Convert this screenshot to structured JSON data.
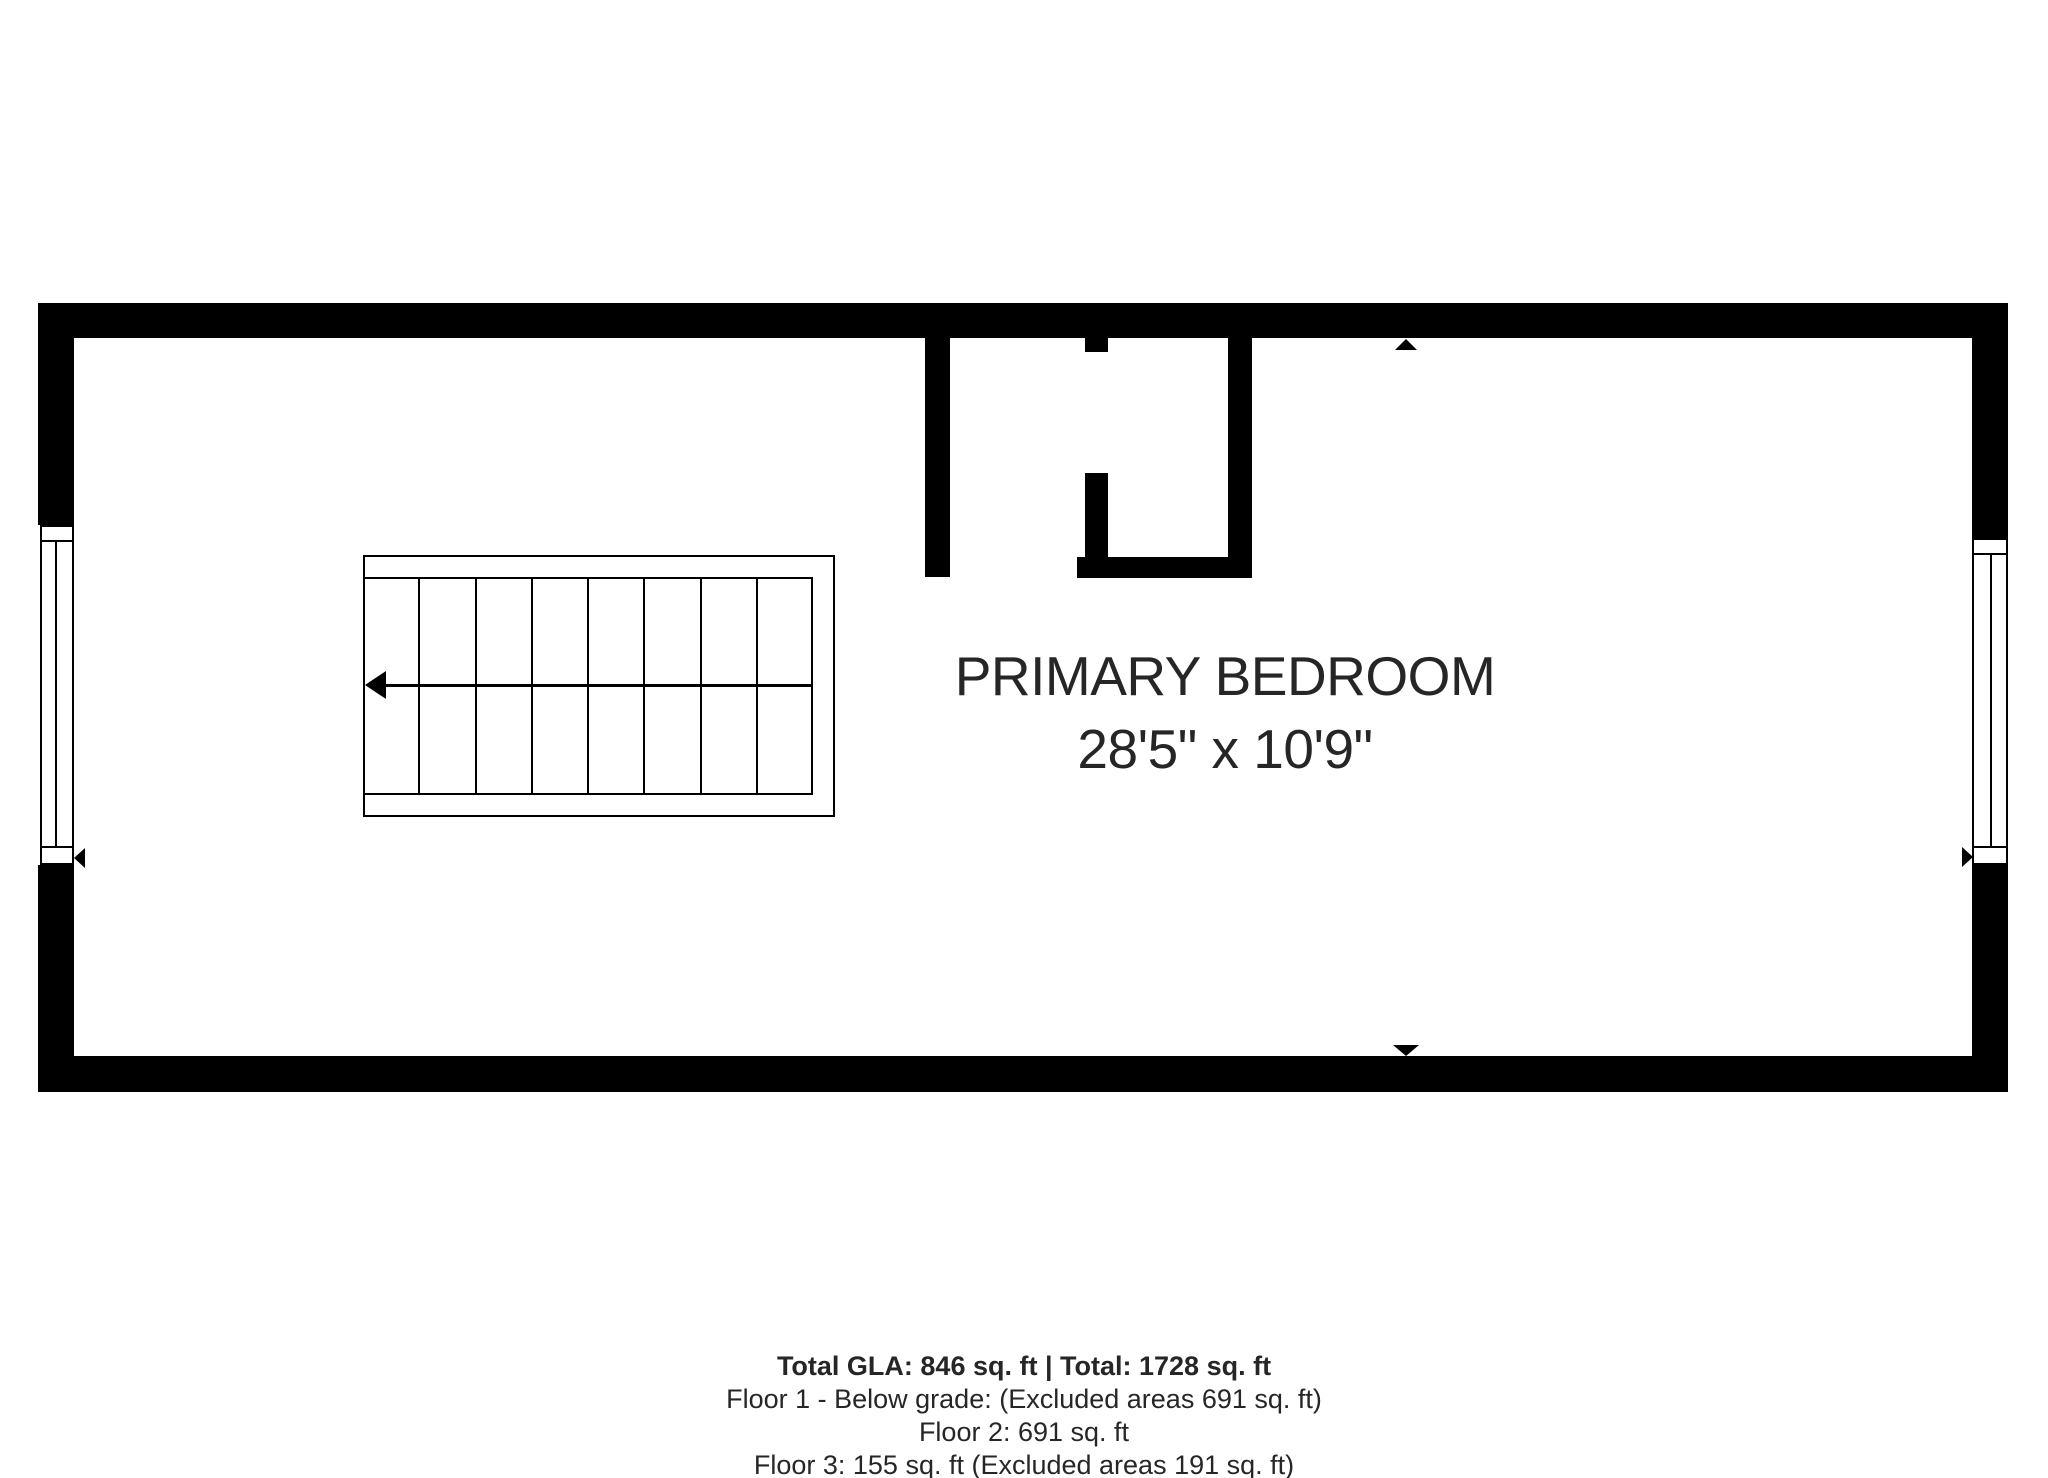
{
  "colors": {
    "wall": "#000000",
    "background": "#ffffff",
    "text": "#262626"
  },
  "room": {
    "name": "PRIMARY BEDROOM",
    "dimensions": "28'5\" x 10'9\""
  },
  "footer": {
    "total_line": "Total GLA: 846 sq. ft | Total: 1728 sq. ft",
    "floor1_line": "Floor 1 - Below grade: (Excluded areas 691 sq. ft)",
    "floor2_line": "Floor 2: 691 sq. ft",
    "floor3_line": "Floor 3: 155 sq. ft (Excluded areas 191 sq. ft)"
  },
  "stairs": {
    "columns": 8,
    "direction": "left"
  },
  "markers": {
    "top_wall": "up-triangle",
    "bottom_wall": "down-triangle",
    "left_wall": "left-triangle",
    "right_wall": "right-triangle"
  }
}
